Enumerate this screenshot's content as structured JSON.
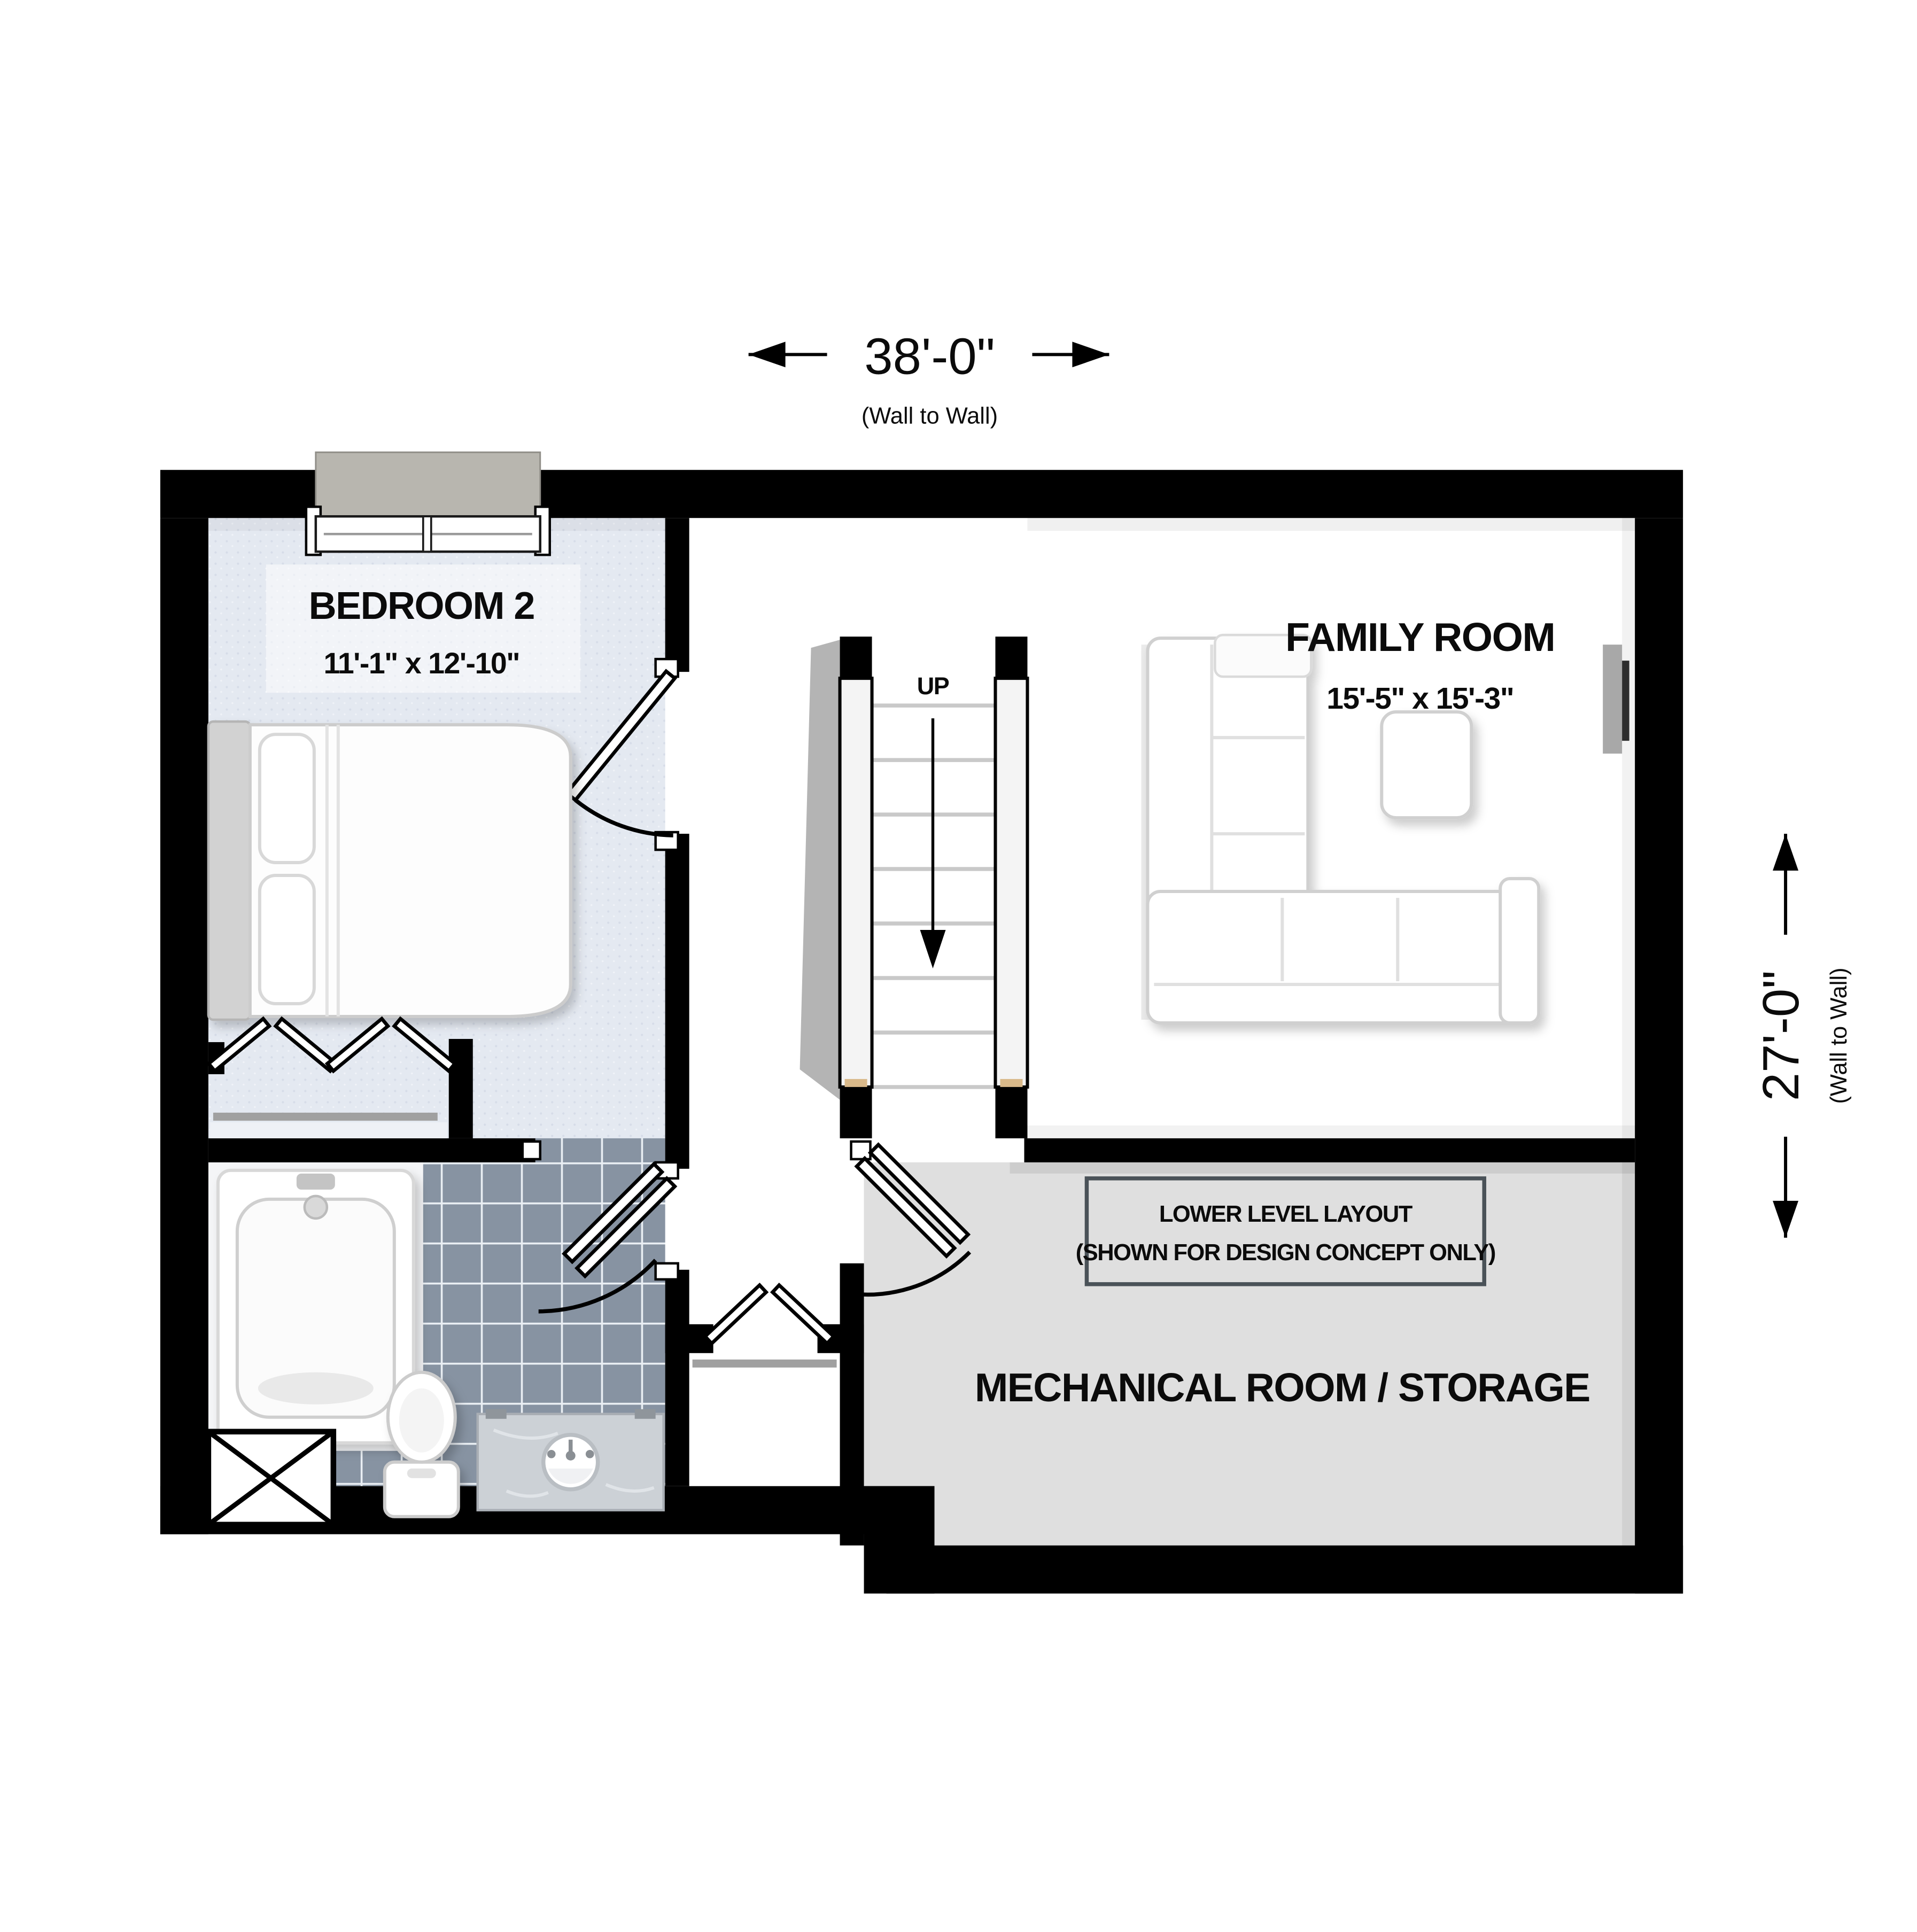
{
  "dimensions": {
    "horizontal": {
      "value": "38'-0\"",
      "note": "(Wall to Wall)"
    },
    "vertical": {
      "value": "27'-0\"",
      "note": "(Wall to Wall)"
    }
  },
  "rooms": {
    "bedroom2": {
      "name": "BEDROOM 2",
      "size": "11'-1\" x 12'-10\""
    },
    "family_room": {
      "name": "FAMILY ROOM",
      "size": "15'-5\" x 15'-3\""
    },
    "mechanical_room": {
      "name": "MECHANICAL ROOM / STORAGE"
    },
    "stairs": {
      "label": "UP"
    }
  },
  "note_box": {
    "line1": "LOWER LEVEL LAYOUT",
    "line2": "(SHOWN FOR DESIGN CONCEPT ONLY)"
  },
  "colors": {
    "wall": "#000000",
    "bedroom_floor": "#e4e9f1",
    "bedroom_dot": "#d6dce8",
    "bath_tile": "#8793a2",
    "grout": "#e9eef3",
    "mech_floor": "#dfdfdf",
    "hall_floor": "#ffffff"
  }
}
